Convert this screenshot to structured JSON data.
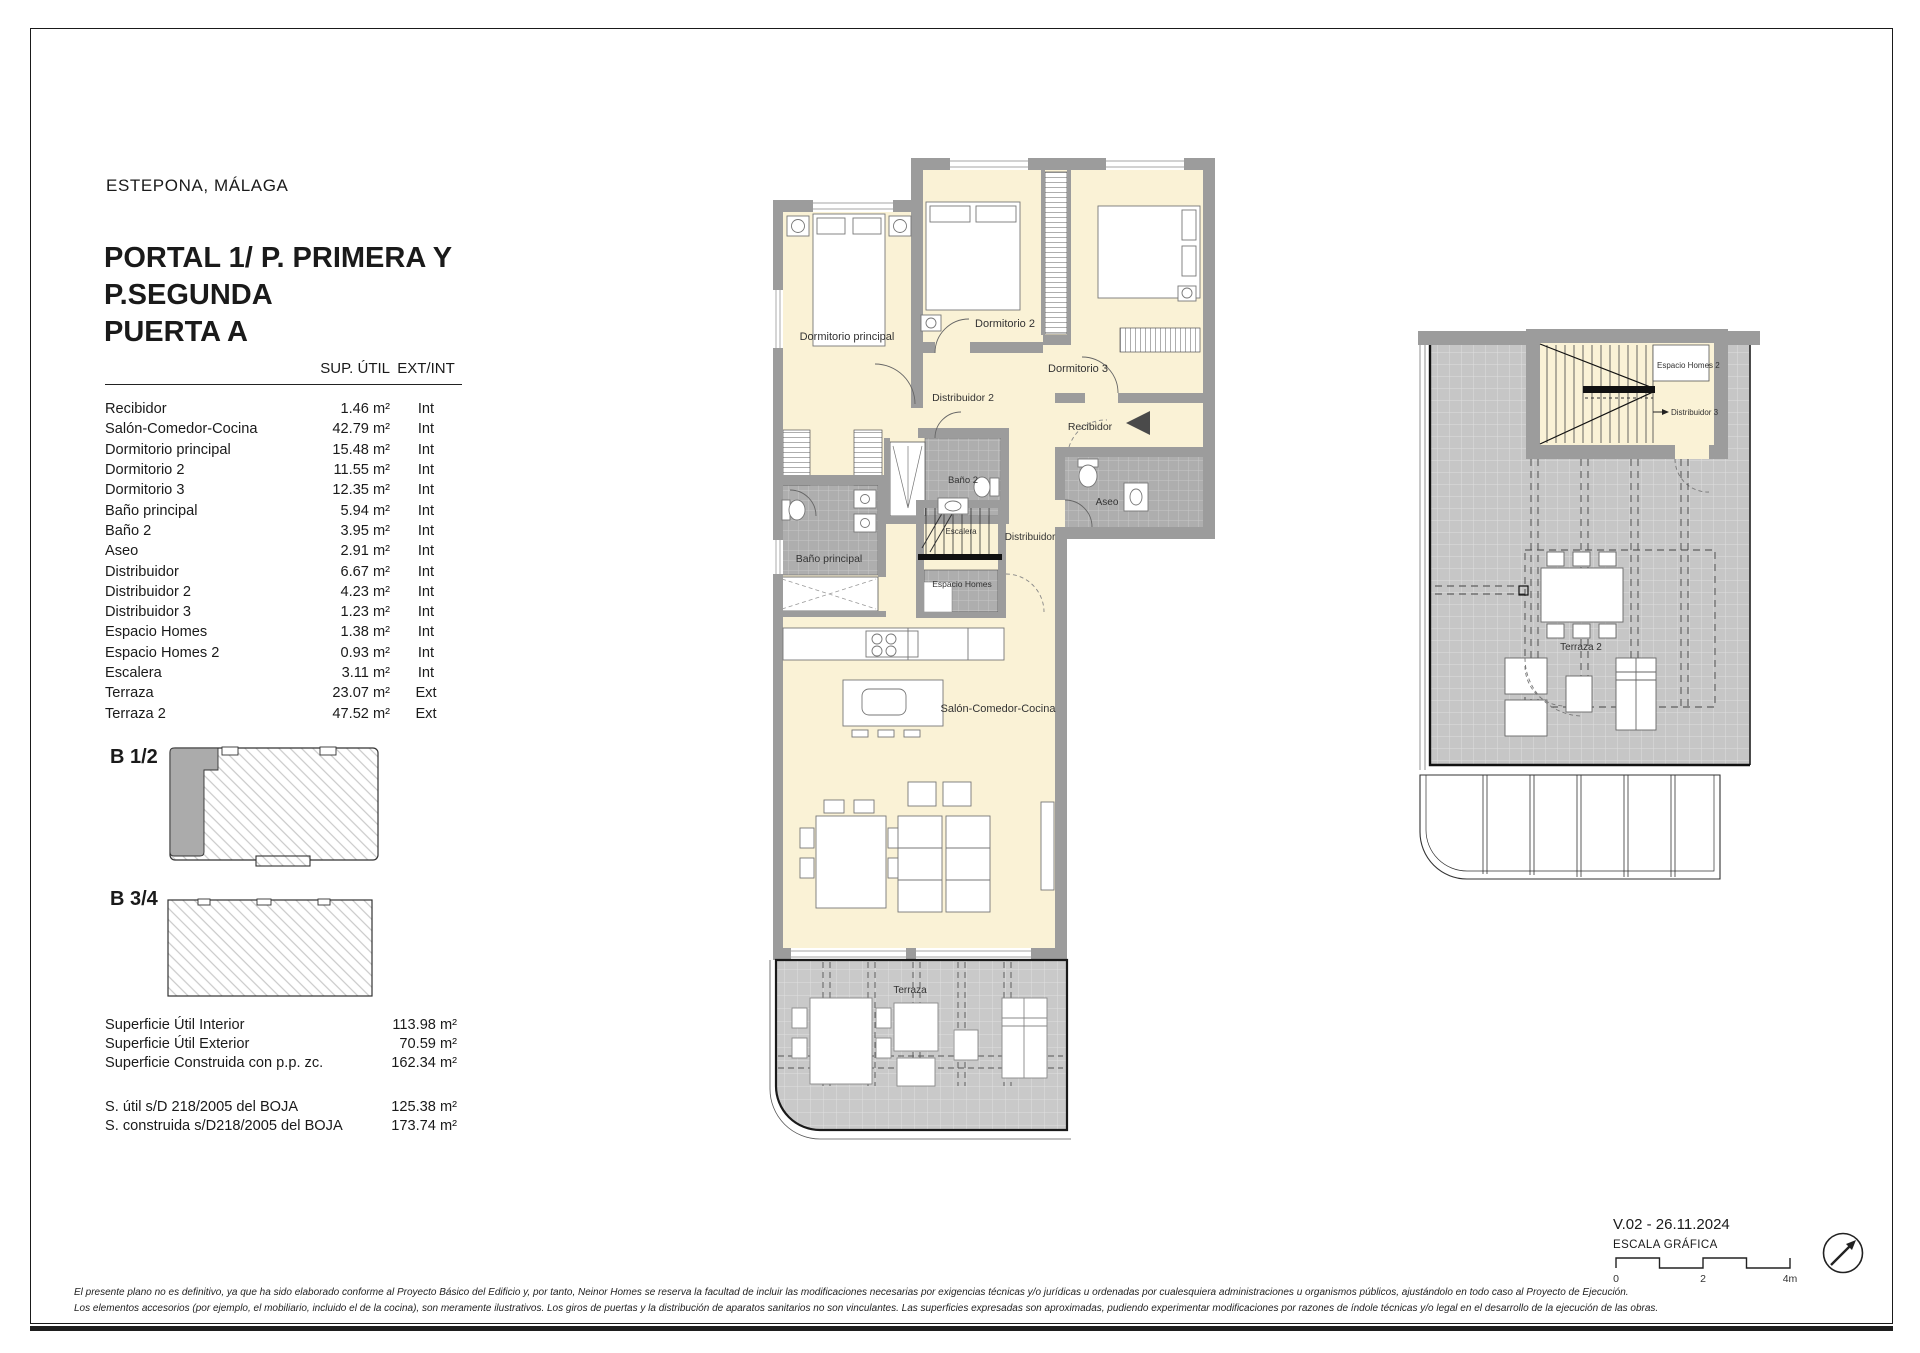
{
  "header": {
    "location": "ESTEPONA, MÁLAGA",
    "title_lines": [
      "PORTAL 1/ P. PRIMERA Y",
      "P.SEGUNDA",
      "PUERTA A"
    ]
  },
  "areas_table": {
    "columns": {
      "area": "SUP. ÚTIL",
      "extint": "EXT/INT"
    },
    "rows": [
      {
        "name": "Recibidor",
        "area": "1.46 m²",
        "type": "Int"
      },
      {
        "name": "Salón-Comedor-Cocina",
        "area": "42.79 m²",
        "type": "Int"
      },
      {
        "name": "Dormitorio principal",
        "area": "15.48 m²",
        "type": "Int"
      },
      {
        "name": "Dormitorio 2",
        "area": "11.55 m²",
        "type": "Int"
      },
      {
        "name": "Dormitorio 3",
        "area": "12.35 m²",
        "type": "Int"
      },
      {
        "name": "Baño principal",
        "area": "5.94 m²",
        "type": "Int"
      },
      {
        "name": "Baño 2",
        "area": "3.95 m²",
        "type": "Int"
      },
      {
        "name": "Aseo",
        "area": "2.91 m²",
        "type": "Int"
      },
      {
        "name": "Distribuidor",
        "area": "6.67 m²",
        "type": "Int"
      },
      {
        "name": "Distribuidor 2",
        "area": "4.23 m²",
        "type": "Int"
      },
      {
        "name": "Distribuidor 3",
        "area": "1.23 m²",
        "type": "Int"
      },
      {
        "name": "Espacio Homes",
        "area": "1.38 m²",
        "type": "Int"
      },
      {
        "name": "Espacio Homes 2",
        "area": "0.93 m²",
        "type": "Int"
      },
      {
        "name": "Escalera",
        "area": "3.11 m²",
        "type": "Int"
      },
      {
        "name": "Terraza",
        "area": "23.07 m²",
        "type": "Ext"
      },
      {
        "name": "Terraza 2",
        "area": "47.52 m²",
        "type": "Ext"
      }
    ]
  },
  "key_plans": {
    "plan1_label": "B 1/2",
    "plan2_label": "B 3/4"
  },
  "summary": {
    "rows": [
      {
        "label": "Superficie Útil Interior",
        "value": "113.98 m²"
      },
      {
        "label": "Superficie Útil Exterior",
        "value": "70.59 m²"
      },
      {
        "label": "Superficie Construida con p.p. zc.",
        "value": "162.34 m²"
      }
    ],
    "boja_rows": [
      {
        "label": "S. útil s/D 218/2005 del BOJA",
        "value": "125.38 m²"
      },
      {
        "label": "S. construida s/D218/2005 del BOJA",
        "value": "173.74 m²"
      }
    ]
  },
  "main_plan_labels": {
    "dormitorio_principal": "Dormitorio principal",
    "dormitorio_2": "Dormitorio 2",
    "dormitorio_3": "Dormitorio 3",
    "distribuidor_2": "Distribuidor 2",
    "recibidor": "Recibidor",
    "bano_2": "Baño 2",
    "bano_principal": "Baño principal",
    "aseo": "Aseo",
    "escalera": "Escalera",
    "distribuidor": "Distribuidor",
    "espacio_homes": "Espacio Homes",
    "salon": "Salón-Comedor-Cocina",
    "terraza": "Terraza"
  },
  "upper_plan_labels": {
    "espacio_homes_2": "Espacio Homes 2",
    "distribuidor_3": "Distribuidor 3",
    "terraza_2": "Terraza 2"
  },
  "footer": {
    "version": "V.02 - 26.11.2024",
    "scale_title": "ESCALA GRÁFICA",
    "scale_ticks": [
      "0",
      "2",
      "4m"
    ],
    "disclaimer_line1": "El presente plano no es definitivo, ya que ha sido elaborado conforme al Proyecto Básico del Edificio y, por tanto, Neinor Homes se reserva la facultad de incluir las modificaciones necesarias por exigencias técnicas y/o jurídicas u ordenadas por cualesquiera administraciones u organismos públicos, ajustándolo en todo caso al Proyecto de Ejecución.",
    "disclaimer_line2": "Los elementos accesorios (por ejemplo, el mobiliario, incluido el de la cocina), son meramente ilustrativos. Los giros de puertas y la distribución de aparatos sanitarios no son vinculantes. Las superficies expresadas son aproximadas, pudiendo experimentar modificaciones por razones de índole técnicas y/o legal en el desarrollo de la ejecución de las obras."
  },
  "colors": {
    "room_fill": "#FAF2D6",
    "wall_gray": "#9C9C9C",
    "tile_gray": "#AEAEAE",
    "terrace_gray": "#C9C9C9",
    "key_highlight": "#ABABAB",
    "line_black": "#1A1A1A"
  }
}
